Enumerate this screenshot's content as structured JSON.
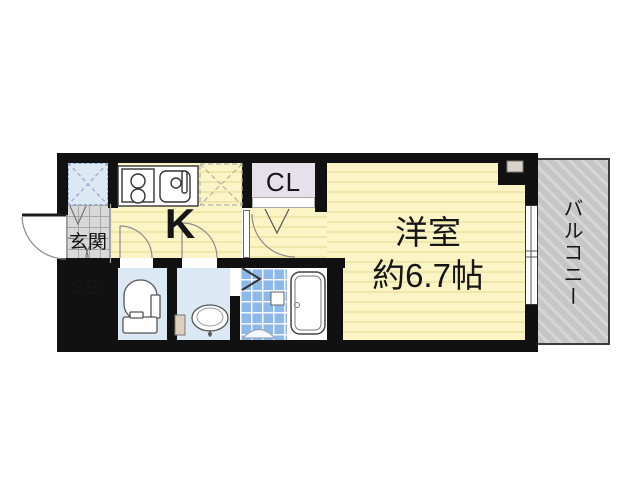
{
  "floorplan": {
    "labels": {
      "entrance": "玄関",
      "shoe_box": "SB",
      "kitchen": "K",
      "closet": "CL",
      "room_name": "洋室",
      "room_size": "約6.7帖",
      "balcony": "バルコニー"
    },
    "colors": {
      "wall": "#111111",
      "room_yellow": "#fbf5c6",
      "room_stripe": "#f1e6aa",
      "water_floor": "#dde8f5",
      "bath_tile": "#8cb9e9",
      "closet_fill": "#e6e0ea",
      "entrance_tile": "#d8d8d8",
      "balcony_fill": "#c6c6c6",
      "balcony_stripe": "#d6d6d6"
    }
  }
}
